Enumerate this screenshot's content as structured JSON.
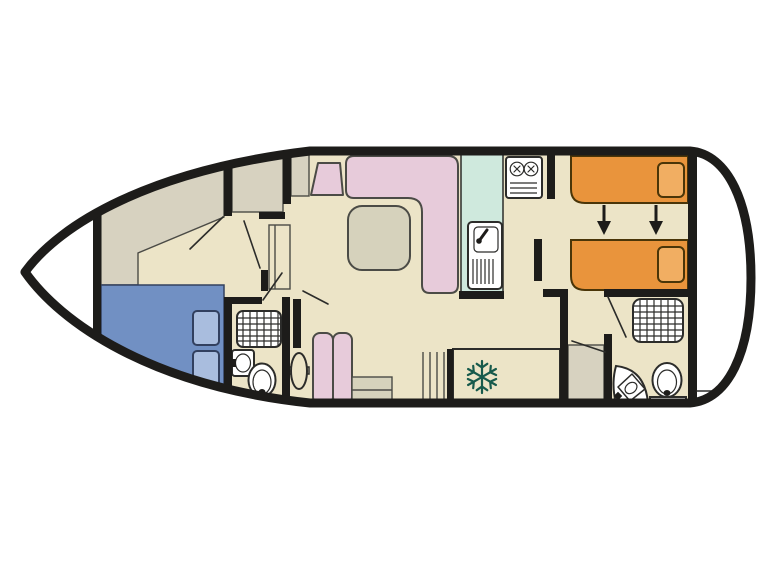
{
  "figure": {
    "kind": "boat-deck-floor-plan",
    "orientation": "bow-left-stern-right"
  },
  "colors": {
    "background": "#ffffff",
    "wall": "#1d1c1a",
    "line": "#2c2c2a",
    "floor": "#ece4c7",
    "deck": "#d7d2c0",
    "white": "#ffffff",
    "double_bed": "#7190c3",
    "double_pillow": "#a9bdde",
    "single_bed": "#e9943c",
    "single_pillow": "#f1ae62",
    "sofa": "#e7cbda",
    "table": "#d6d2bc",
    "galley_counter": "#cfe9dd",
    "fridge": "#c9e7da",
    "snowflake": "#175a4c",
    "fixture": "#ffffff",
    "arrow": "#1d1c1a"
  },
  "icons": {
    "fridge": "snowflake-icon",
    "stove": "two-burner-hob-icon",
    "shower": "grid-shower-tray-icon",
    "toilet": "toilet-bowl-icon",
    "basin": "washbasin-icon",
    "helm": "helm-wheel-icon",
    "bed_convert": "double-down-arrows-icon",
    "steps": "companionway-steps-icon"
  }
}
